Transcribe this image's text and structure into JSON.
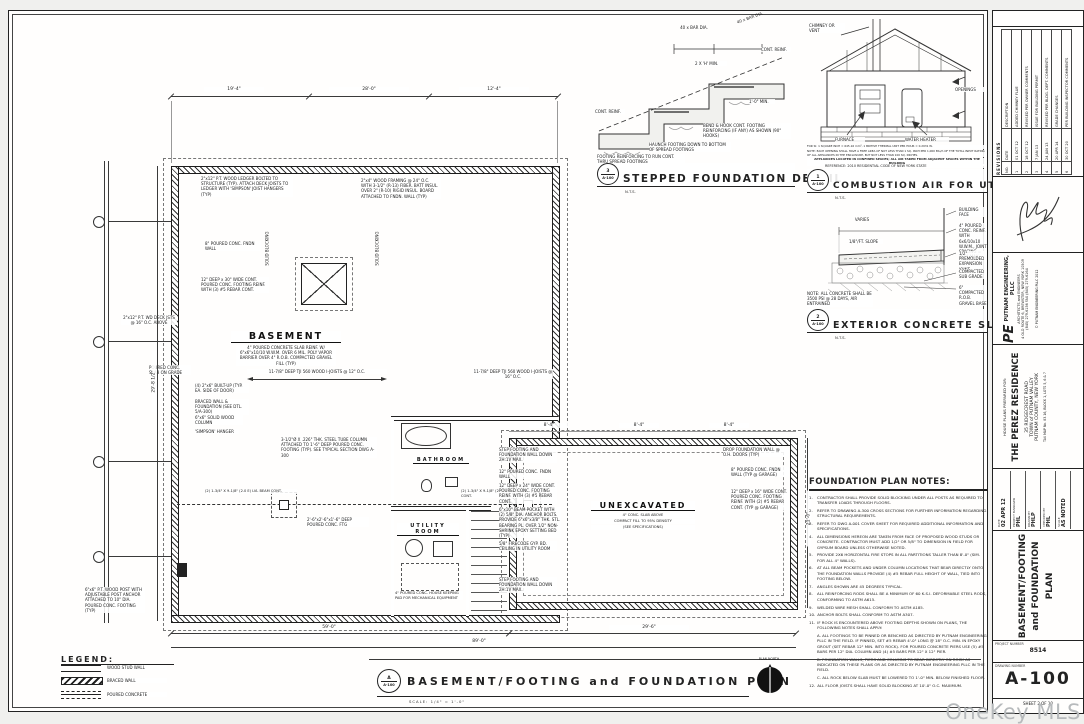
{
  "wm": "OneKey MLS",
  "plan": {
    "marker_letter": "A",
    "marker_ref": "A-100",
    "title": "BASEMENT/FOOTING and FOUNDATION PLAN",
    "scale": "SCALE:  1/4\" = 1'-0\"",
    "north": "PLAN NORTH",
    "rooms": {
      "basement": "BASEMENT",
      "bathroom": "BATHROOM",
      "utility": "UTILITY ROOM",
      "unexcavated": "UNEXCAVATED",
      "unex1": "4\" CONC. SLAB ABOVE",
      "unex2": "COMPACT FILL TO 95% DENSITY",
      "unex3": "(SEE SPECIFICATIONS)"
    }
  },
  "legend": {
    "title": "LEGEND:",
    "stud": "WOOD STUD WALL",
    "braced": "BRACED WALL",
    "poured": "POURED CONCRETE"
  },
  "dims": {
    "top1": "19'-4\"",
    "top2": "28'-0\"",
    "top3": "12'-4\"",
    "left": "29'-8 1/2\"",
    "right": "21'-0\"",
    "seg1": "59'-0\"",
    "seg2": "29'-6\"",
    "overall": "89'-0\"",
    "g1": "8'-4\"",
    "g2": "8'-4\"",
    "g3": "8'-4\""
  },
  "ann": {
    "ledger": "2\"x12\" P.T. WOOD LEDGER BOLTED TO STRUCTURE (TYP).  ATTACH DECK JOISTS TO LEDGER WITH 'SIMPSON' JOIST HANGERS (TYP)",
    "framing_2x4": "2\"x4\" WOOD FRAMING @ 24\" O.C. WITH 3-1/2\" (R-13) FIBER. BATT INSUL. OVER 2\" (R-10) RIGID INSUL. BOARD ATTACHED TO FNDN. WALL (TYP)",
    "fndn_wall_8": "8\" POURED CONC. FNDN WALL",
    "footing_30": "12\" DEEP x 30\" WIDE CONT. POURED CONC. FOOTING REINF. WITH (3) #5 REBAR CONT.",
    "joists_12": "11-7/8\" DEEP TJI 560 WOOD I-JOISTS @ 12\" O.C.",
    "joists_16": "11-7/8\" DEEP TJI 560 WOOD I-JOISTS @ 16\" O.C.",
    "blocking": "SOLID BLOCKING",
    "basement_slab": "4\" POURED CONCRETE SLAB REINF. W/ 6\"x6\"x10/10 W.W.M. OVER 6 MIL. POLY VAPOR BARRIER OVER 4\" R.O.B. COMPACTED GRAVEL FILL (TYP)",
    "steel_col": "3-1/2\"Ø X .226\" THK. STEEL TUBE COLUMN ATTACHED TO 1'-6\" DEEP POURED CONC. FOOTING (TYP). SEE TYPICAL SECTION DWG A-300",
    "lvl_beam": "(2) 1-3/4\" X 9-1/8\" (2.0 E) LVL BEAM CONT.",
    "col_ftg": "2'-6\"x2'-6\"x1'-6\" DEEP POURED CONC. FTG",
    "built_up": "(4) 2\"x6\" BUILT-UP (TYP. EA. SIDE OF DOOR)",
    "braced_note": "BRACED WALL & FOUNDATION (SEE DTL. 5/A-300)",
    "wood_col": "6\"x6\" SOLID WOOD COLUMN",
    "simpson": "'SIMPSON' HANGER",
    "step_footing": "STEP FOOTING AND FOUNDATION WALL DOWN 2H:1V MAX.",
    "wall_12": "12\" POURED CONC. FNDN WALL",
    "footing_24": "12\" DEEP x 24\" WIDE CONT. POURED CONC. FOOTING REINF. WITH (3) #5 REBAR CONT.",
    "beam_pocket": "6\"x10\" BEAM POCKET WITH (2) 5/8\" DIA. ANCHOR BOLTS. PROVIDE 6\"x6\"x3/8\" THK. STL. BEARING PL. OVER 1/2\" NON-SHRINK EPOXY SETTING BED (TYP)",
    "firecode": "5/8\" FIRECODE GYP. BD. CEILING IN UTILITY ROOM",
    "drop_wall": "DROP FOUNDATION WALL @ O.H. DOORS (TYP)",
    "garage_wall": "8\" POURED CONC. FNDN WALL (TYP @ GARAGE)",
    "garage_footing": "12\" DEEP x 16\" WIDE CONT. POURED CONC. FOOTING REINF. WITH (2) #5 REBAR CONT. (TYP @ GARAGE)",
    "housekeeping": "4\" POURED CONC. HOUSE KEEPING PAD FOR MECHANICAL EQUIPMENT",
    "deck_joists": "2\"x12\" P.T. WD DECK JSTS @ 16\" O.C. ABOVE",
    "slab_on_grade": "POURED CONC. SLAB ON GRADE",
    "wood_post": "6\"x6\" P.T. WOOD POST WITH ADJUSTABLE POST ANCHOR ATTACHED TO 10\" DIA. POURED CONC. FOOTING (TYP)"
  },
  "det": {
    "step": {
      "num": "3",
      "ref": "A-100",
      "title": "STEPPED FOUNDATION DETAIL",
      "scale": "N.T.S.",
      "bar_dia": "40 x BAR DIA.",
      "bar_dia2": "40 x BAR DIA.",
      "cont1": "CONT. REINF.",
      "cont2": "CONT. REINF.",
      "two_h": "2 X 'H' MIN.",
      "one_ft": "1'-0\" MIN.",
      "bend": "BEND & HOOK CONT. FOOTING REINFORCING (IF ANY) AS SHOWN (90° HOOKS)",
      "haunch": "HAUNCH FOOTING DOWN TO BOTTOM OF SPREAD FOOTINGS",
      "run": "FOOTING REINFORCING TO RUN CONT. THRU SPREAD FOOTINGS"
    },
    "comb": {
      "num": "1",
      "ref": "A-100",
      "title": "COMBUSTION AIR FOR UTILITY ROOM",
      "scale": "N.T.S.",
      "reference": "REFERENCE:   2010 RESIDENTIAL CODE OF NEW YORK STATE",
      "chimney": "CHIMNEY OR VENT",
      "openings": "OPENINGS",
      "furnace": "FURNACE",
      "water": "WATER HEATER",
      "si": "FOR SI: 1 SQUARE INCH = 645.16 mm², 1 BRITISH THERMAL UNIT PER HOUR = 0.2931 W.",
      "note": "NOTE: EACH OPENING SHALL HAVE A FREE AREA OF NOT LESS THAN 1 SQ. INCH PER 1,000 Btu/h OF THE TOTAL INPUT RATING OF ALL APPLIANCES IN THE ENCLOSURE, BUT NOT LESS THAN 100 SQ. INCHES.",
      "caption": "APPLIANCES LOCATED IN CONFINED SPACES; ALL AIR TAKEN FROM ADJACENT SPACES WITHIN THE BUILDING"
    },
    "slab": {
      "num": "2",
      "ref": "A-100",
      "title": "EXTERIOR CONCRETE SLAB DTL.",
      "scale": "N.T.S.",
      "varies": "VARIES",
      "slope": "1/8\"/FT. SLOPE",
      "face": "BUILDING FACE",
      "conc": "4\" POURED CONC. REINF. WITH 6x6/10x10 W.W.M., JOINT SPACING = 8'-0\" MAX.",
      "joint": "1/2\" PREMOLDED EXPANSION JOINT",
      "subgrade": "COMPACTED SUB GRADE",
      "gravel": "6\" COMPACTED R.O.B. GRAVEL BASE",
      "note": "NOTE: ALL CONCRETE SHALL BE 3500 PSI @ 28 DAYS, AIR ENTRAINED"
    }
  },
  "notes": {
    "title": "FOUNDATION PLAN NOTES:",
    "items": [
      {
        "n": "1.",
        "t": "CONTRACTOR SHALL PROVIDE SOLID BLOCKING UNDER ALL POSTS AS REQUIRED TO TRANSFER LOADS THROUGH FLOORS."
      },
      {
        "n": "2.",
        "t": "REFER TO DRAWING A-300 CROSS SECTIONS FOR FURTHER INFORMATION REGARDING STRUCTURAL REQUIREMENTS."
      },
      {
        "n": "3.",
        "t": "REFER TO DWG A-001 COVER SHEET FOR REQUIRED ADDITIONAL INFORMATION AND SPECIFICATIONS."
      },
      {
        "n": "4.",
        "t": "ALL DIMENSIONS HEREON ARE TAKEN FROM FACE OF PROPOSED WOOD STUDS OR CONCRETE. CONTRACTOR MUST ADD 1/2\" OR 5/8\" TO DIMENSION IN FIELD FOR GYPSUM BOARD UNLESS OTHERWISE NOTED."
      },
      {
        "n": "5.",
        "t": "PROVIDE 2X6 HORIZONTAL FIRE STOPS IN ALL PARTITIONS TALLER THAN 8'-0\" (SIM. FOR ALL 4\" WALLS)."
      },
      {
        "n": "6.",
        "t": "AT ALL BEAM POCKETS AND UNDER COLUMN LOCATIONS THAT BEAR DIRECTLY ONTO THE FOUNDATION WALLS PROVIDE (4) #5 REBAR FULL HEIGHT OF WALL, TIED INTO FOOTING BELOW."
      },
      {
        "n": "7.",
        "t": "ANGLES SHOWN ARE 45 DEGREES TYPICAL."
      },
      {
        "n": "8.",
        "t": "ALL REINFORCING RODS SHALL BE A MINIMUM OF 60 K.S.I. DEFORMABLE STEEL RODS, CONFORMING TO ASTM A615."
      },
      {
        "n": "9.",
        "t": "WELDED WIRE MESH SHALL CONFORM TO ASTM A185."
      },
      {
        "n": "10.",
        "t": "ANCHOR BOLTS SHALL CONFORM TO ASTM A307."
      },
      {
        "n": "11.",
        "t": "IF ROCK IS ENCOUNTERED ABOVE FOOTING DEPTHS SHOWN ON PLANS, THE FOLLOWING NOTES SHALL APPLY:"
      },
      {
        "n": "",
        "t": "A.  ALL FOOTINGS TO BE PINNED OR BENCHED AS DIRECTED BY PUTNAM ENGINEERING PLLC IN THE FIELD. IF PINNED, SET #5 REBAR 4'-0\" LONG @ 18\" O.C. MIN. IN EPOXY GROUT (SET REBAR 12\" MIN. INTO ROCK). FOR POURED CONCRETE PIERS USE (5) #5 BARS PER 12\" DIA. COLUMN AND (4) #5 BARS PER 12\" X 12\" PIER."
      },
      {
        "n": "",
        "t": "B.  FOUNDATION WALLS, PIERS AND COLUMNS TO BEAR DIRECTLY ON ROCK AS INDICATED ON THESE PLANS OR AS DIRECTED BY PUTNAM ENGINEERING PLLC IN THE FIELD."
      },
      {
        "n": "",
        "t": "C.  ALL ROCK BELOW SLAB MUST BE LOWERED TO 1'-0\" MIN. BELOW FINISHED FLOOR."
      },
      {
        "n": "12.",
        "t": "ALL FLOOR JOISTS SHALL HAVE SOLID BLOCKING AT 10'-0\" O.C. MAXIMUM."
      }
    ]
  },
  "tb": {
    "revisions_title": "REVISIONS",
    "rev_cols": {
      "no": "NO.",
      "date": "DATE",
      "desc": "DESCRIPTION"
    },
    "revisions": [
      {
        "no": "1",
        "date": "01 OCT 12",
        "desc": "ADDED CHIMNEY FLUE"
      },
      {
        "no": "2",
        "date": "18 OCT 12",
        "desc": "REVISED PER OWNER COMMENTS"
      },
      {
        "no": "3",
        "date": "7 JAN 13",
        "desc": "ISSUE FOR BUILDING PERMIT"
      },
      {
        "no": "4",
        "date": "24 JAN 13",
        "desc": "REVISED PER BLDG. DEPT. COMMENTS"
      },
      {
        "no": "5",
        "date": "20 APR 14",
        "desc": "GRADE CHANGES"
      },
      {
        "no": "6",
        "date": "30 OCT 20",
        "desc": "PER BUILDING INSPECTOR COMMENTS"
      }
    ],
    "firm": {
      "monogram": "PE",
      "name": "PUTNAM ENGINEERING, PLLC",
      "tagline": "ARCHITECTS and ENGINEERS",
      "address": "4 OLD ROUTE 6, BREWSTER, NEW YORK 10509",
      "phone": "(845) 279-6156    FAX (845) 279-6164",
      "copyright": "© PUTNAM ENGINEERING PLLC 2012"
    },
    "project": {
      "prepared_for": "HOUSE PLANS PREPARED FOR:",
      "name": "THE PEREZ RESIDENCE",
      "addr1": "35 RIDGECREST ROAD",
      "addr2": "TOWN of PUTNAM VALLEY",
      "addr3": "PUTNAM COUNTY, NEW YORK",
      "tax": "TAX MAP No. 83.16, BLOCK 1, LOTS 5, 6 & 7"
    },
    "info": [
      {
        "label": "DATE",
        "value": "02 APR 12"
      },
      {
        "label": "PROJECT MANAGER",
        "value": "PHL"
      },
      {
        "label": "DRAWN BY",
        "value": "PHLP"
      },
      {
        "label": "CHECKED BY",
        "value": "PHL"
      },
      {
        "label": "SCALE",
        "value": "AS NOTED"
      }
    ],
    "drawing_title": "BASEMENT/FOOTING and FOUNDATION PLAN",
    "project_number_label": "PROJECT NUMBER",
    "project_number": "8514",
    "drawing_number_label": "DRAWING NUMBER",
    "drawing_number": "A-100",
    "sheet": "SHEET   2   OF   10"
  }
}
